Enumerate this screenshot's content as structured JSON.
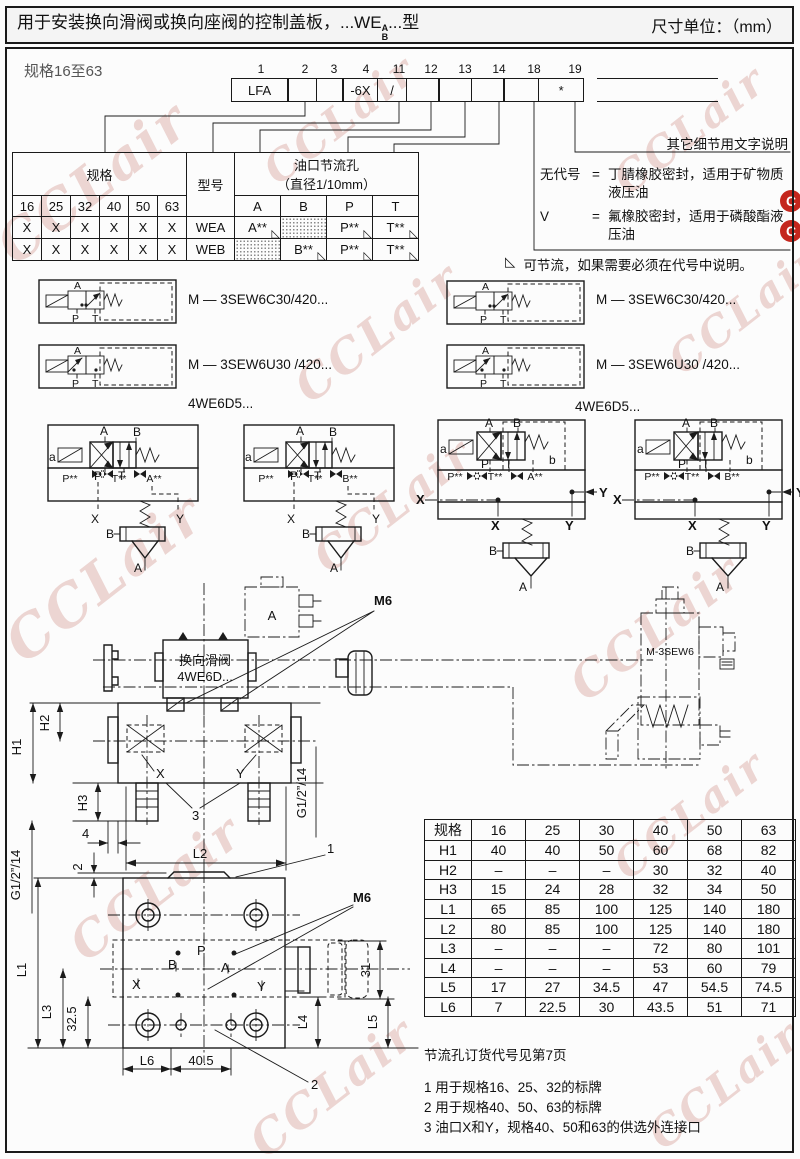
{
  "header": {
    "title_prefix": "用于安装换向滑阀或换向座阀的控制盖板，...WE",
    "title_stack_top": "A",
    "title_stack_bottom": "B",
    "title_suffix": "...型",
    "units": "尺寸单位：（mm）"
  },
  "size_range_label": "规格16至63",
  "model_code": {
    "positions": [
      "1",
      "2",
      "3",
      "4",
      "11",
      "12",
      "13",
      "14",
      "18",
      "19"
    ],
    "cells": [
      "LFA",
      "",
      "",
      "-6X",
      "/",
      "",
      "",
      "",
      "",
      "*"
    ]
  },
  "spec_table": {
    "spec_header": "规格",
    "model_header": "型号",
    "throttle_header_l1": "油口节流孔",
    "throttle_header_l2": "（直径1/10mm）",
    "sizes": [
      "16",
      "25",
      "32",
      "40",
      "50",
      "63"
    ],
    "port_headers": [
      "A",
      "B",
      "P",
      "T"
    ],
    "tri": "◺",
    "rows": [
      {
        "marks": [
          "X",
          "X",
          "X",
          "X",
          "X",
          "X"
        ],
        "model": "WEA",
        "a": "A**",
        "b": "",
        "p": "P**",
        "t": "T**"
      },
      {
        "marks": [
          "X",
          "X",
          "X",
          "X",
          "X",
          "X"
        ],
        "model": "WEB",
        "a": "",
        "b": "B**",
        "p": "P**",
        "t": "T**"
      }
    ]
  },
  "notes": {
    "other_details": "其它细节用文字说明",
    "seal1_key": "无代号",
    "seal1_eq": "=",
    "seal1_text": "丁腈橡胶密封，适用于矿物质液压油",
    "seal2_key": "V",
    "seal2_eq": "=",
    "seal2_text": "氟橡胶密封，适用于磷酸酯液压油",
    "throttle_mark": "◺",
    "throttle_note": "可节流，如果需要必须在代号中说明。"
  },
  "symbol_section": {
    "left1": "M — 3SEW6C30/420...",
    "left2": "M — 3SEW6U30 /420...",
    "right1": "M — 3SEW6C30/420...",
    "right2": "M — 3SEW6U30 /420...",
    "we_left": "4WE6D5...",
    "we_right": "4WE6D5..."
  },
  "labels": {
    "A": "A",
    "B": "B",
    "P": "P",
    "T": "T",
    "X": "X",
    "Y": "Y",
    "a": "a",
    "b": "b",
    "Pss": "P**",
    "Tss": "T**",
    "Ass": "A**",
    "Bss": "B**",
    "M6": "M6",
    "H1": "H1",
    "H2": "H2",
    "H3": "H3",
    "L1": "L1",
    "L2": "L2",
    "L3": "L3",
    "L4": "L4",
    "L5": "L5",
    "L6": "L6",
    "G12": "G1/2”/14",
    "dim2": "2",
    "dim4": "4",
    "dim31": "31",
    "dim32_5": "32.5",
    "dim40_5": "40.5",
    "callout1": "1",
    "callout2": "2",
    "callout3": "3",
    "valve_line1": "换向滑阀",
    "valve_line2": "4WE6D...",
    "m3sew6": "M-3SEW6"
  },
  "dim_table": {
    "corner": "规格",
    "columns": [
      "16",
      "25",
      "30",
      "40",
      "50",
      "63"
    ],
    "rows": [
      {
        "label": "H1",
        "values": [
          "40",
          "40",
          "50",
          "60",
          "68",
          "82"
        ]
      },
      {
        "label": "H2",
        "values": [
          "–",
          "–",
          "–",
          "30",
          "32",
          "40"
        ]
      },
      {
        "label": "H3",
        "values": [
          "15",
          "24",
          "28",
          "32",
          "34",
          "50"
        ]
      },
      {
        "label": "L1",
        "values": [
          "65",
          "85",
          "100",
          "125",
          "140",
          "180"
        ]
      },
      {
        "label": "L2",
        "values": [
          "80",
          "85",
          "100",
          "125",
          "140",
          "180"
        ]
      },
      {
        "label": "L3",
        "values": [
          "–",
          "–",
          "–",
          "72",
          "80",
          "101"
        ]
      },
      {
        "label": "L4",
        "values": [
          "–",
          "–",
          "–",
          "53",
          "60",
          "79"
        ]
      },
      {
        "label": "L5",
        "values": [
          "17",
          "27",
          "34.5",
          "47",
          "54.5",
          "74.5"
        ]
      },
      {
        "label": "L6",
        "values": [
          "7",
          "22.5",
          "30",
          "43.5",
          "51",
          "71"
        ]
      }
    ]
  },
  "footnotes": {
    "orifice": "节流孔订货代号见第7页",
    "item1": "1 用于规格16、25、32的标牌",
    "item2": "2 用于规格40、50、63的标牌",
    "item3": "3 油口X和Y，规格40、50和63的供选外连接口"
  },
  "watermark": {
    "text": "CCLair",
    "logo_letter": "C"
  }
}
